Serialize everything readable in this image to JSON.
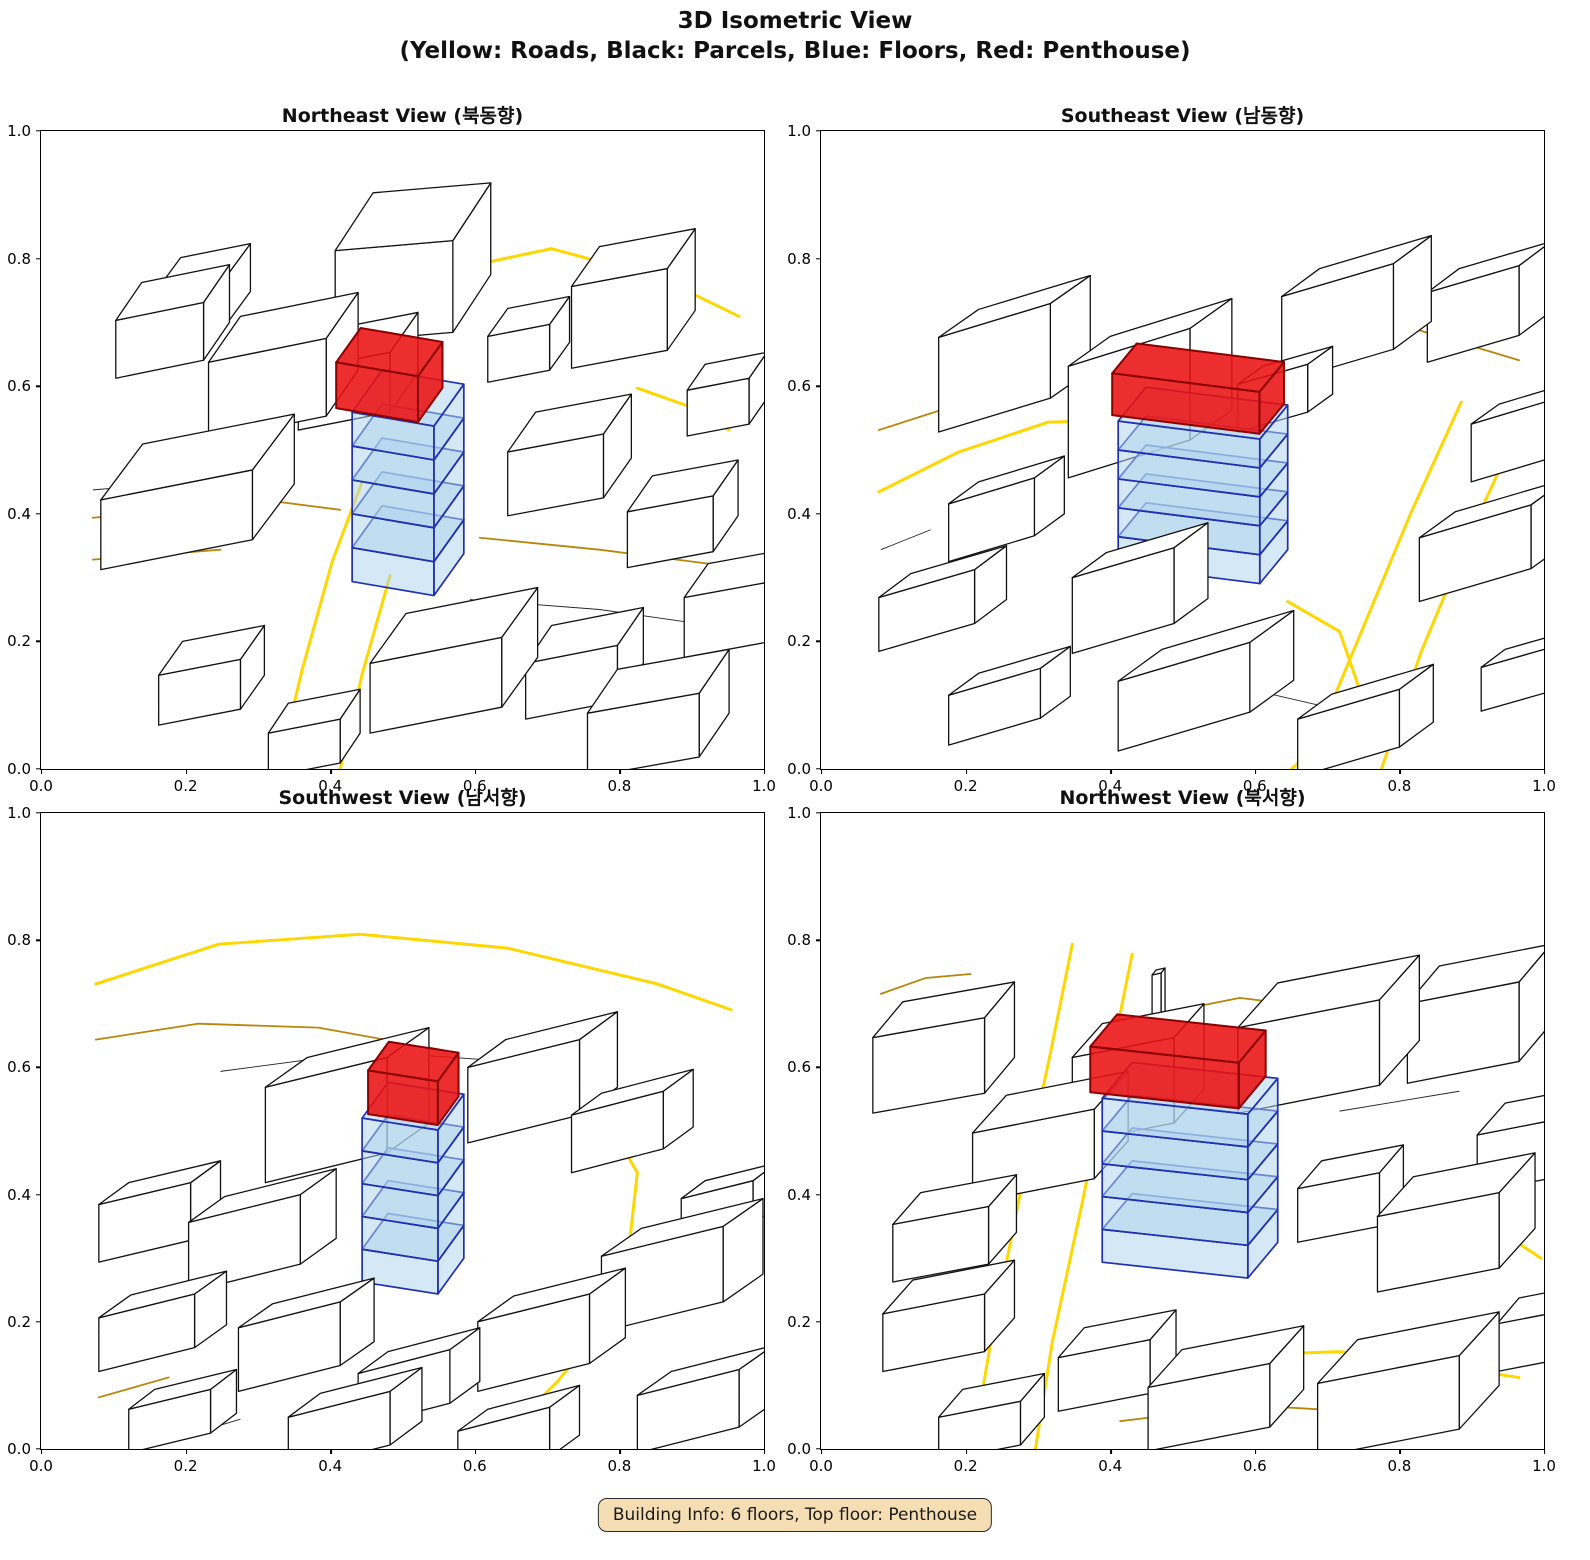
{
  "figure": {
    "title_line1": "3D Isometric View",
    "title_line2": "(Yellow: Roads, Black: Parcels, Blue: Floors, Red: Penthouse)"
  },
  "subplots": [
    {
      "title": "Northeast View (북동향)"
    },
    {
      "title": "Southeast View (남동향)"
    },
    {
      "title": "Southwest View (남서향)"
    },
    {
      "title": "Northwest View (북서향)"
    }
  ],
  "axis": {
    "tick_labels": [
      "0.0",
      "0.2",
      "0.4",
      "0.6",
      "0.8",
      "1.0"
    ],
    "range": [
      0,
      1
    ]
  },
  "badge": {
    "text": "Building Info: 6 floors, Top floor: Penthouse"
  },
  "chart_data": {
    "type": "3d-isometric-city-view-grid",
    "title": "3D Isometric View",
    "subtitle": "(Yellow: Roads, Black: Parcels, Blue: Floors, Red: Penthouse)",
    "views": [
      {
        "name": "Northeast View",
        "korean": "북동향"
      },
      {
        "name": "Southeast View",
        "korean": "남동향"
      },
      {
        "name": "Southwest View",
        "korean": "남서향"
      },
      {
        "name": "Northwest View",
        "korean": "북서향"
      }
    ],
    "legend": {
      "roads": "Yellow",
      "parcels": "Black",
      "floors": "Blue",
      "penthouse": "Red"
    },
    "building": {
      "total_floors": 6,
      "top_floor": "Penthouse",
      "blue_floors": 5
    },
    "axis_ticks": [
      0.0,
      0.2,
      0.4,
      0.6,
      0.8,
      1.0
    ],
    "axis_range": [
      0,
      1
    ],
    "grid": false,
    "colors": {
      "road": "#FFD700",
      "road_dark": "#B8860B",
      "parcel_edge": "#111111",
      "building_fill": "#FFFFFF",
      "floor_fill": "#AED3EC",
      "floor_edge": "#2030B0",
      "penthouse_fill": "#EA1111",
      "penthouse_edge": "#8B0000",
      "badge_bg": "#F5DEB3",
      "badge_border": "#2B2B2B",
      "background": "#FFFFFF"
    }
  }
}
